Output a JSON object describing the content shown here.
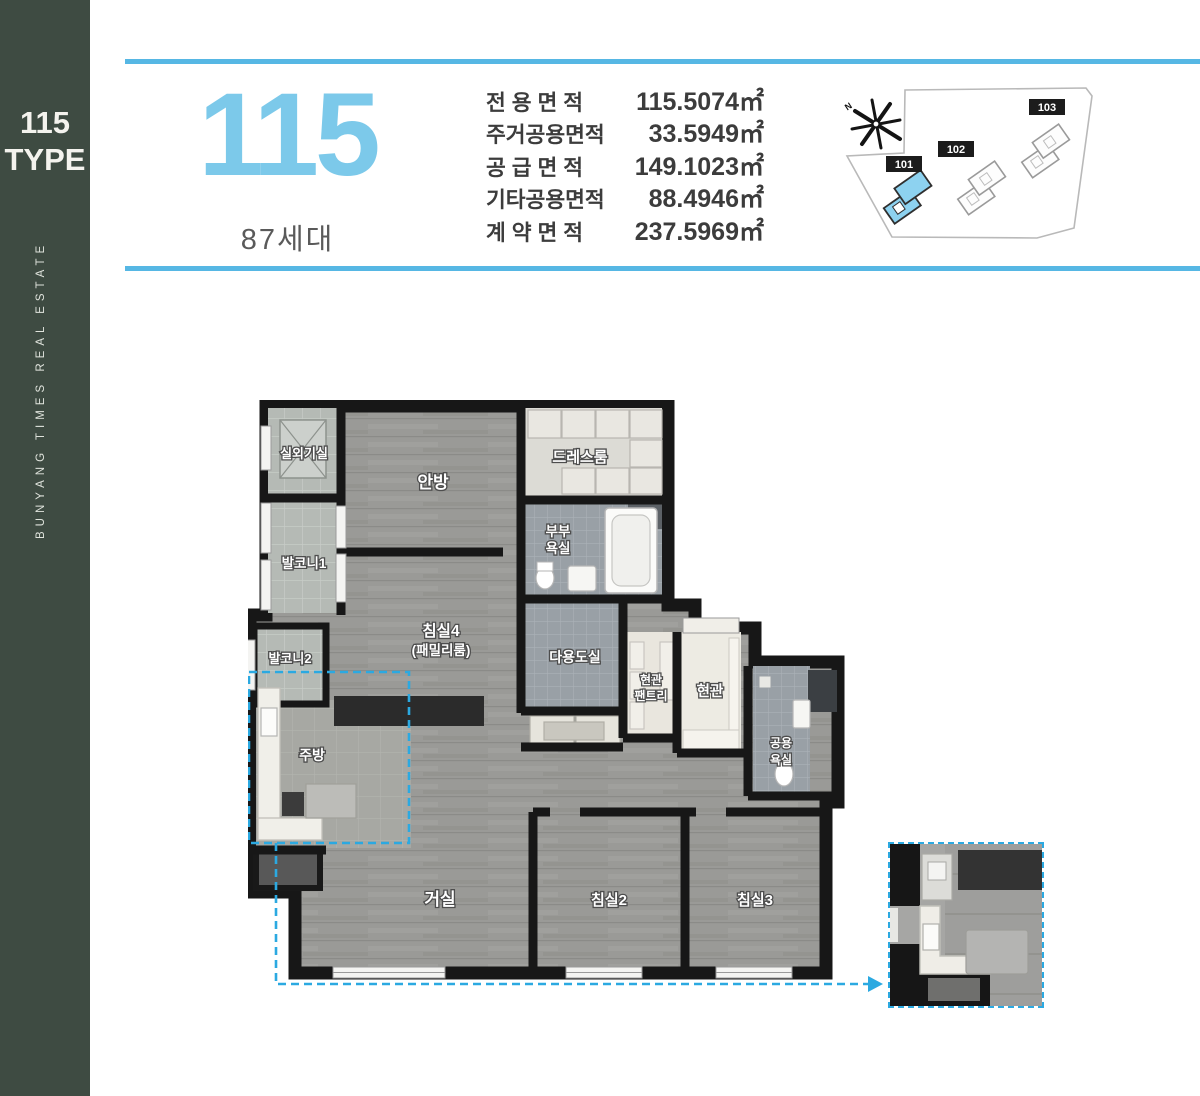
{
  "sidebar": {
    "bg": "#3e4b42",
    "type_number": "115",
    "type_word": "TYPE",
    "brand_vertical": "BUNYANG TIMES REAL ESTATE"
  },
  "header": {
    "accent_color": "#56b7e4",
    "type_big": "115",
    "units": "87세대",
    "area_table": {
      "rows": [
        {
          "label": "전 용 면 적",
          "value": "115.5074㎡"
        },
        {
          "label": "주거공용면적",
          "value": "33.5949㎡"
        },
        {
          "label": "공 급 면 적",
          "value": "149.1023㎡"
        },
        {
          "label": "기타공용면적",
          "value": "88.4946㎡"
        },
        {
          "label": "계 약 면 적",
          "value": "237.5969㎡"
        }
      ]
    }
  },
  "site_plan": {
    "compass_label": "N",
    "highlight_color": "#8dd2f0",
    "buildings": [
      {
        "label": "101",
        "highlighted": true
      },
      {
        "label": "102",
        "highlighted": false
      },
      {
        "label": "103",
        "highlighted": false
      }
    ]
  },
  "floorplan": {
    "highlight_color": "#2ba9e1",
    "rooms": {
      "outdoor_unit": "실외기실",
      "balcony1": "발코니1",
      "master": "안방",
      "dress": "드레스룸",
      "couple_bath_l1": "부부",
      "couple_bath_l2": "욕실",
      "bed4_l1": "침실4",
      "bed4_l2": "(패밀리룸)",
      "balcony2": "발코니2",
      "utility": "다용도실",
      "pantry_l1": "현관",
      "pantry_l2": "팬트리",
      "entrance": "현관",
      "common_bath_l1": "공용",
      "common_bath_l2": "욕실",
      "kitchen": "주방",
      "living": "거실",
      "bed2": "침실2",
      "bed3": "침실3"
    }
  }
}
